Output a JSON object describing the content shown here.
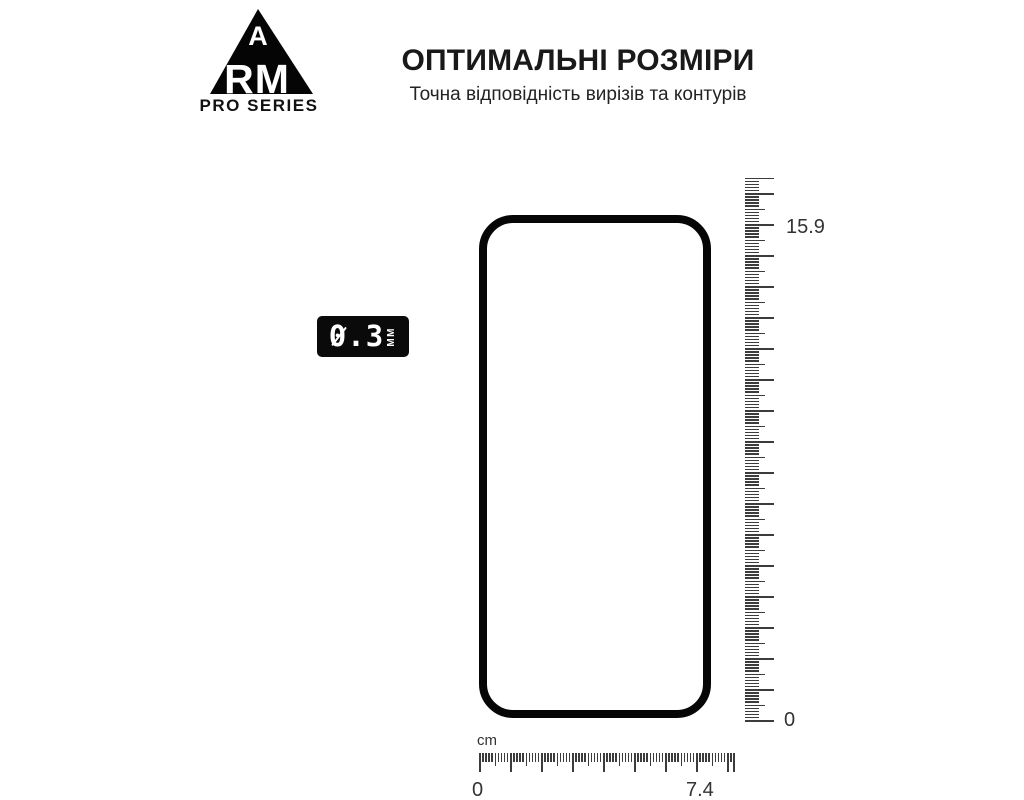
{
  "brand": {
    "letter_top": "A",
    "letters_bottom": "RM",
    "series_label": "PRO SERIES"
  },
  "header": {
    "title": "ОПТИМАЛЬНІ РОЗМІРИ",
    "subtitle": "Точна відповідність вирізів та контурів"
  },
  "thickness_badge": {
    "value": "0.3",
    "unit": "MM"
  },
  "vertical_ruler": {
    "max_label": "15.9",
    "min_label": "0"
  },
  "horizontal_ruler": {
    "unit_label": "cm",
    "min_label": "0",
    "max_label": "7.4"
  },
  "measurements": {
    "height_cm": 15.9,
    "width_cm": 7.4,
    "thickness_mm": 0.3
  },
  "colors": {
    "ink": "#1a1a1a",
    "tick": "#3c3c3c",
    "badge_bg": "#0a0a0a",
    "outline": "#060606"
  }
}
